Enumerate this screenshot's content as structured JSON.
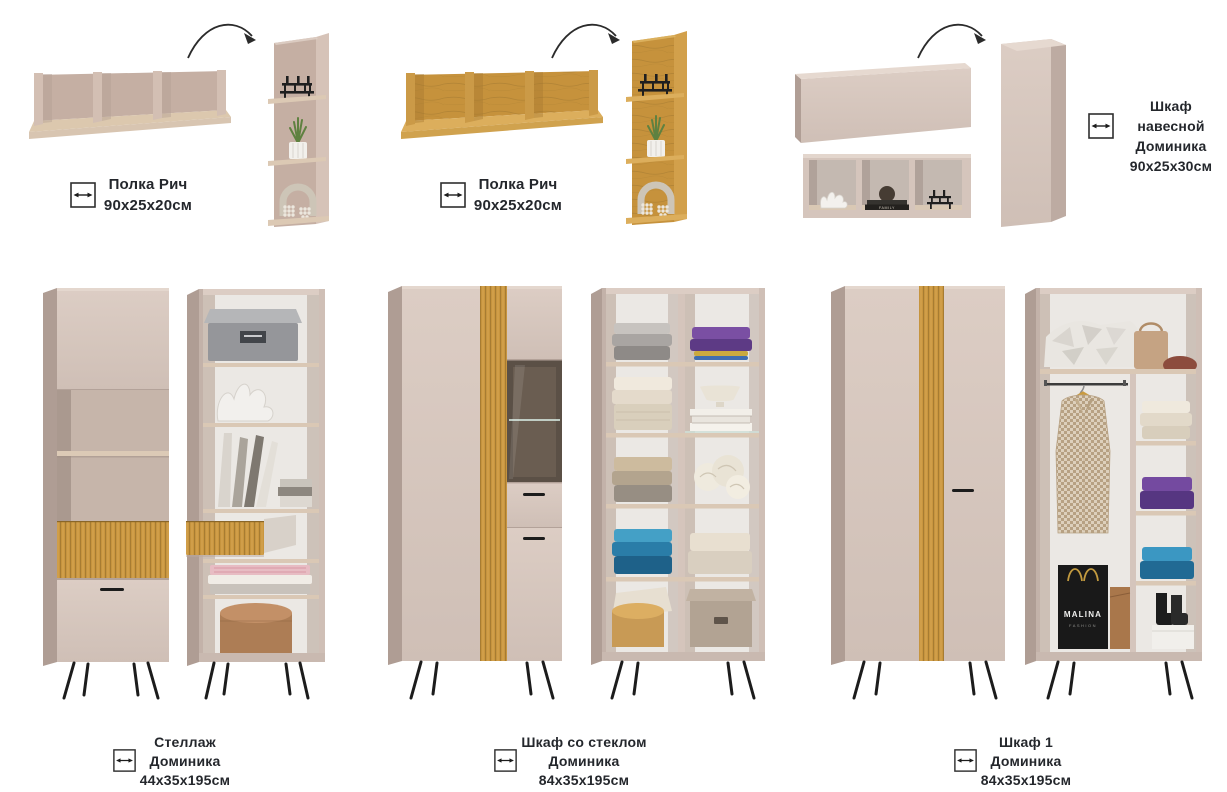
{
  "page": {
    "background": "#ffffff"
  },
  "labels": [
    {
      "line1": "Полка Рич",
      "line2": "90х25х20см"
    },
    {
      "line1": "Полка Рич",
      "line2": "90х25х20см"
    },
    {
      "line1": "Шкаф навесной",
      "line2": "Доминика",
      "line3": "90х25х30см"
    },
    {
      "line1": "Стеллаж",
      "line2": "Доминика",
      "line3": "44х35х195см"
    },
    {
      "line1": "Шкаф со стеклом",
      "line2": "Доминика",
      "line3": "84х35х195см"
    },
    {
      "line1": "Шкаф 1",
      "line2": "Доминика",
      "line3": "84х35х195см"
    }
  ],
  "decor": {
    "book_text": "FAMILY",
    "bag_text": "MALINA",
    "bag_subtext": "FASHION"
  },
  "colors": {
    "beige_front": "#d5c5bc",
    "beige_side": "#af9d94",
    "beige_top": "#e4d7ce",
    "oak": "#c9963f",
    "oak_line": "#8a6628",
    "interior_dark": "#5b5046",
    "wall_white": "#ebe8e4",
    "legs_black": "#1c1c1c",
    "text": "#24272c"
  }
}
